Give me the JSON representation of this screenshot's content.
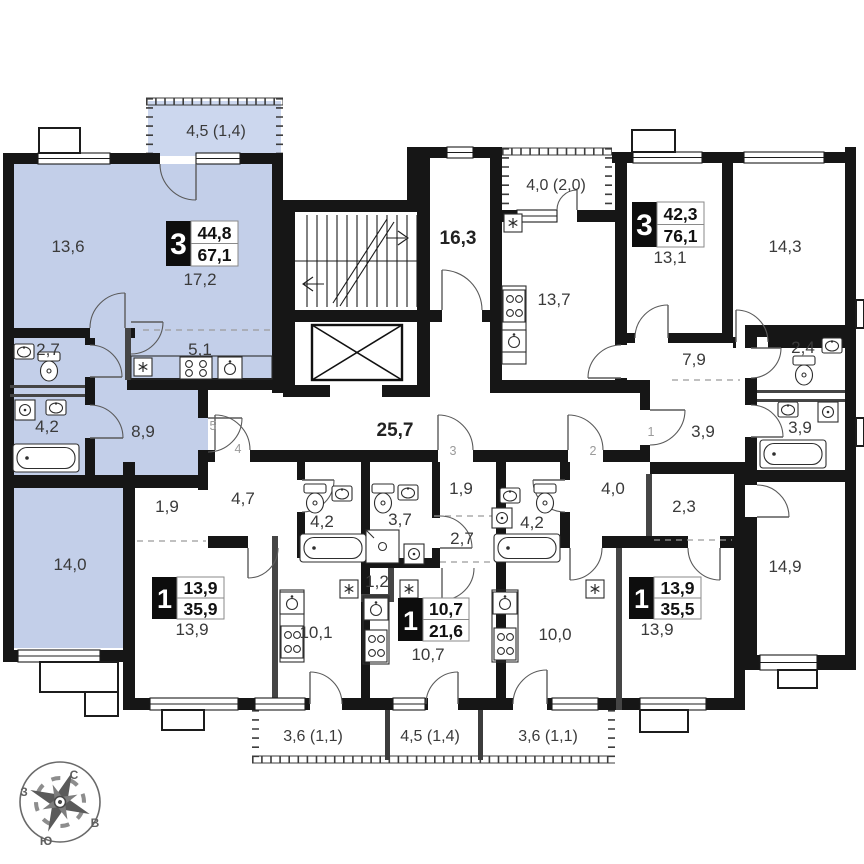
{
  "plan_title": "floor-plan",
  "colors": {
    "highlight": "#c3cfe9",
    "highlight_light": "#ccd7ee",
    "wall": "#161616",
    "label": "#3a3a3a",
    "badge_black": "#0d0d0d"
  },
  "badges": {
    "apt5": {
      "count": "3",
      "living": "44,8",
      "total": "67,1"
    },
    "apt1": {
      "count": "3",
      "living": "42,3",
      "total": "76,1"
    },
    "apt4": {
      "count": "1",
      "living": "13,9",
      "total": "35,9"
    },
    "apt3": {
      "count": "1",
      "living": "10,7",
      "total": "21,6"
    },
    "apt2": {
      "count": "1",
      "living": "13,9",
      "total": "35,5"
    }
  },
  "rooms": {
    "balcony_tl": "4,5 (1,4)",
    "r13_6": "13,6",
    "r17_2": "17,2",
    "k5_1": "5,1",
    "wc2_7": "2,7",
    "b4_2": "4,2",
    "h8_9": "8,9",
    "r14_0": "14,0",
    "lobby": "16,3",
    "corridor": "25,7",
    "balcony_tr": "4,0 (2,0)",
    "k13_7": "13,7",
    "r13_1": "13,1",
    "r14_3": "14,3",
    "h7_9": "7,9",
    "wc2_4": "2,4",
    "b3_9": "3,9",
    "h3_9": "3,9",
    "r14_9": "14,9",
    "h1_9a": "1,9",
    "h4_7": "4,7",
    "b4_2a": "4,2",
    "r13_9a": "13,9",
    "k10_1": "10,1",
    "b3_7": "3,7",
    "h1_9b": "1,9",
    "h2_7b": "2,7",
    "n1_2": "1,2",
    "r10_7": "10,7",
    "b4_2c": "4,2",
    "h4_0": "4,0",
    "h2_3": "2,3",
    "k10_0": "10,0",
    "r13_9c": "13,9",
    "balcony_b1": "3,6 (1,1)",
    "balcony_b2": "4,5 (1,4)",
    "balcony_b3": "3,6 (1,1)"
  },
  "doors": {
    "d1": "1",
    "d2": "2",
    "d3": "3",
    "d4": "4",
    "d5": "5"
  },
  "compass": {
    "n": "С",
    "e": "В",
    "s": "Ю",
    "w": "З"
  }
}
